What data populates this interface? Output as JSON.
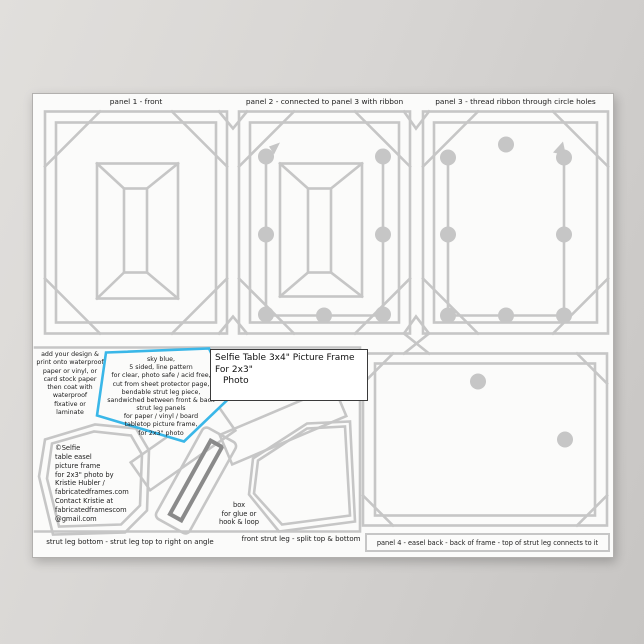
{
  "colors": {
    "line": "#c6c6c6",
    "slot_dark": "#8a8a8a",
    "accent_blue": "#3ab7e8",
    "text": "#202020",
    "poster_bg": "#fbfbfa"
  },
  "poster": {
    "top_labels": [
      {
        "id": "panel1",
        "label": "panel 1 - front"
      },
      {
        "id": "panel2",
        "label": "panel 2 - connected to panel 3 with ribbon"
      },
      {
        "id": "panel3",
        "label": "panel 3 - thread ribbon through circle holes"
      }
    ],
    "bottom_labels": [
      {
        "id": "strut_leg_bottom",
        "label": "strut leg bottom - strut leg top to right on angle"
      },
      {
        "id": "front_strut_leg",
        "label": "front strut leg - split top & bottom"
      },
      {
        "id": "panel4",
        "label": "panel 4 - easel back - back of frame - top of strut leg connects to it"
      }
    ],
    "title_lines": [
      "Selfie Table 3x4\" Picture Frame",
      "For 2x3\"",
      "Photo"
    ],
    "notes": {
      "add_design_lines": [
        "add your design &",
        "print onto waterproof",
        "paper or vinyl, or",
        "card stock paper",
        "then coat with",
        "waterproof",
        "fixative or",
        "laminate"
      ],
      "pentagon_lines": [
        "sky blue,",
        "5 sided, line pattern",
        "for clear, photo safe / acid free,",
        "cut from sheet protector page,",
        "bendable strut leg piece,",
        "sandwiched between front & back",
        "strut leg panels",
        "for paper / vinyl / board",
        "tabletop picture frame,",
        "for 2x3\" photo"
      ],
      "copyright_lines": [
        "©Selfie",
        "table easel",
        "picture frame",
        "for 2x3\" photo by",
        "Kristie Hubler /",
        "fabricatedframes.com",
        "Contact Kristie at",
        "fabricatedframescom",
        "@gmail.com"
      ],
      "glue_box_lines": [
        "box",
        "for glue or",
        "hook & loop"
      ]
    }
  }
}
